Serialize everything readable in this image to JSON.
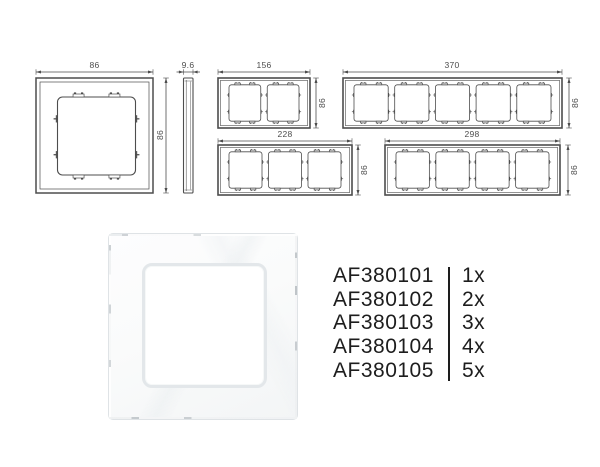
{
  "drawings": {
    "single": {
      "width": "86",
      "height": "86"
    },
    "side": {
      "thickness": "9.6"
    },
    "gang2": {
      "width": "156",
      "height": "86"
    },
    "gang3": {
      "width": "228",
      "height": "86"
    },
    "gang4": {
      "width": "298",
      "height": "86"
    },
    "gang5": {
      "width": "370",
      "height": "86"
    }
  },
  "products": [
    {
      "code": "AF380101",
      "qty": "1x"
    },
    {
      "code": "AF380102",
      "qty": "2x"
    },
    {
      "code": "AF380103",
      "qty": "3x"
    },
    {
      "code": "AF380104",
      "qty": "4x"
    },
    {
      "code": "AF380105",
      "qty": "5x"
    }
  ],
  "colors": {
    "line": "#4d4d4d",
    "dim_text": "#4d4d4d",
    "list_text": "#1d1d1d",
    "photo_edge": "#dfe3e6",
    "background": "#ffffff"
  }
}
